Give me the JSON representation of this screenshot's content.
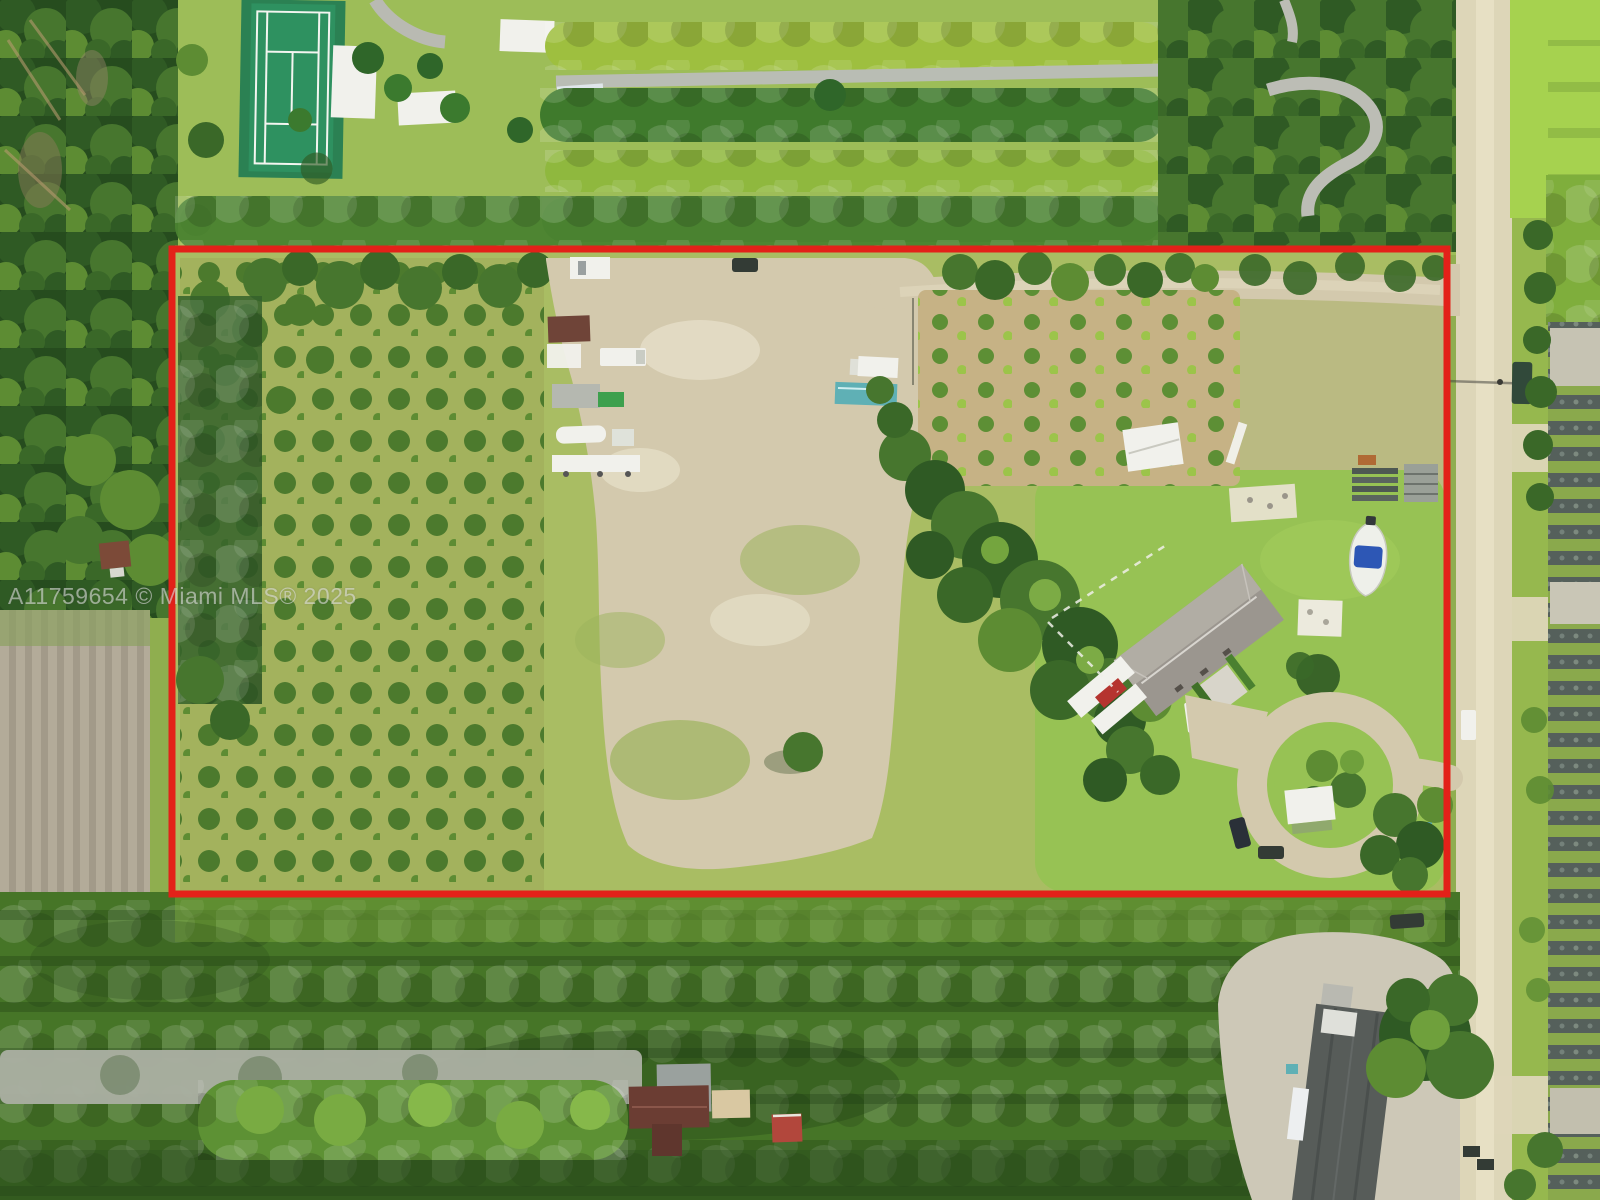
{
  "image": {
    "type": "aerial-drone-photograph",
    "subject": "Aerial view of a large agricultural / nursery parcel outlined in red",
    "width_px": 1600,
    "height_px": 1200
  },
  "watermark": {
    "text": "A11759654 © Miami MLS® 2025",
    "color": "#d9d9d9"
  },
  "boundary": {
    "label": "property boundary outline",
    "color": "#e32119",
    "shape": "rectangle"
  },
  "palette": {
    "grassBase": "#8fae4f",
    "grassTop": "#9dbd58",
    "lawn": "#97c254",
    "olive": "#a9bd63",
    "orchGrass": "#a3b25d",
    "tree1": "#4c7a2d",
    "tree2": "#5d8f35",
    "canA": "#2f5a24",
    "canB": "#47762e",
    "canC": "#5d8c33",
    "canD": "#3a6828",
    "bushA": "#7fae3c",
    "bushB": "#9cc44a",
    "forest": "#264c1e",
    "hedgeBase": "#467527",
    "dirt": "#d3c9ad",
    "dirtLight": "#e6dfc8",
    "road": "#ddd6b8",
    "roadLight": "#eae3c8",
    "field": "#b3ab99",
    "fieldDark": "#a29a89",
    "white": "#f1f1ec",
    "roofGray": "#9b968f",
    "roofGrayLight": "#b5b1a8",
    "roofBrown": "#6b3d33",
    "roofDark": "#575c59",
    "patio": "#d9c8a2",
    "redShed": "#b2473c",
    "carRed": "#b5342f",
    "boatBlue": "#2d57b5",
    "teal": "#5fb0b5",
    "truckGreen": "#31493a",
    "darkCar": "#333b35",
    "yard": "#cdc8b7",
    "nurseryDark": "#55605b",
    "nurseryLight": "#8aa94c",
    "court": "#2e9160",
    "courtPad": "#2b8153"
  },
  "features": {
    "tennis_court": "neighboring tennis court (top left)",
    "hedgerow_field": "rows of round nursery trees (top center)",
    "winding_path": "curved gray path (top right)",
    "street": "unpaved street running along the right side",
    "nursery_rows": "shade-cloth nursery rows (far right)",
    "orchard": "grove of small fruit trees (left half of parcel)",
    "clearing": "cleared dirt staging area with parked trailers and boats",
    "fruit_grove": "young fruit tree rows on bare soil (center right)",
    "main_house": "gray hip-roof house with RV and boat",
    "driveway_loop": "looped driveway with white carport",
    "plowed_field": "furrowed field (lower left)",
    "south_hedges": "dense hedge rows south of the parcel",
    "barn": "dark-roofed barn on neighboring lot (bottom right)"
  }
}
